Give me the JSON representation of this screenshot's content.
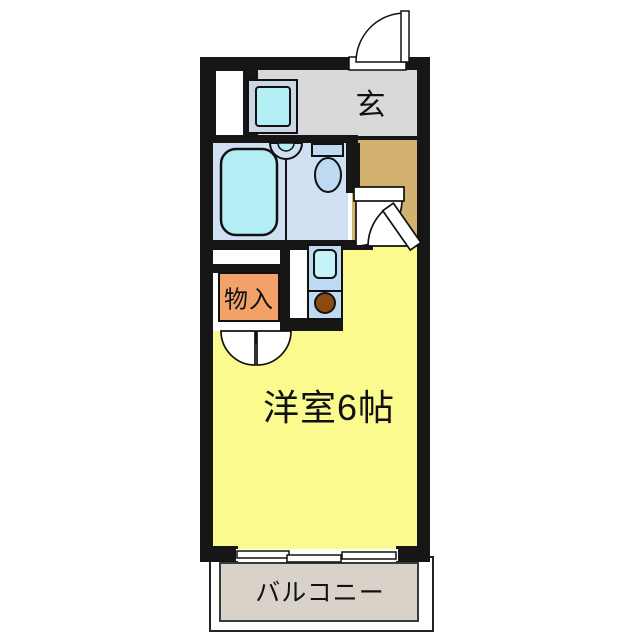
{
  "floorplan": {
    "labels": {
      "entrance": "玄",
      "closet": "物入",
      "main_room": "洋室6帖",
      "balcony": "バルコニー"
    },
    "colors": {
      "wall": "#161616",
      "entrance_floor": "#d9d9d9",
      "hall_floor": "#d2b26e",
      "bathroom_floor": "#cfe0f2",
      "closet_fill": "#f2a268",
      "room_fill": "#fafa8e",
      "balcony_fill": "#d9d2c8",
      "fixture_blue": "#bedaf2",
      "water_cyan": "#b3eef5",
      "pan_gray_blue": "#ccd7e6",
      "burner_brown": "#8c4a12"
    },
    "fixture_icons": [
      "bathtub-icon",
      "wash-basin-icon",
      "toilet-icon",
      "washing-machine-pan-icon",
      "kitchen-sink-icon",
      "stove-burner-icon",
      "entrance-door-icon",
      "room-door-icon",
      "bathroom-door-icon",
      "closet-double-door-icon",
      "sliding-window-icon"
    ]
  }
}
